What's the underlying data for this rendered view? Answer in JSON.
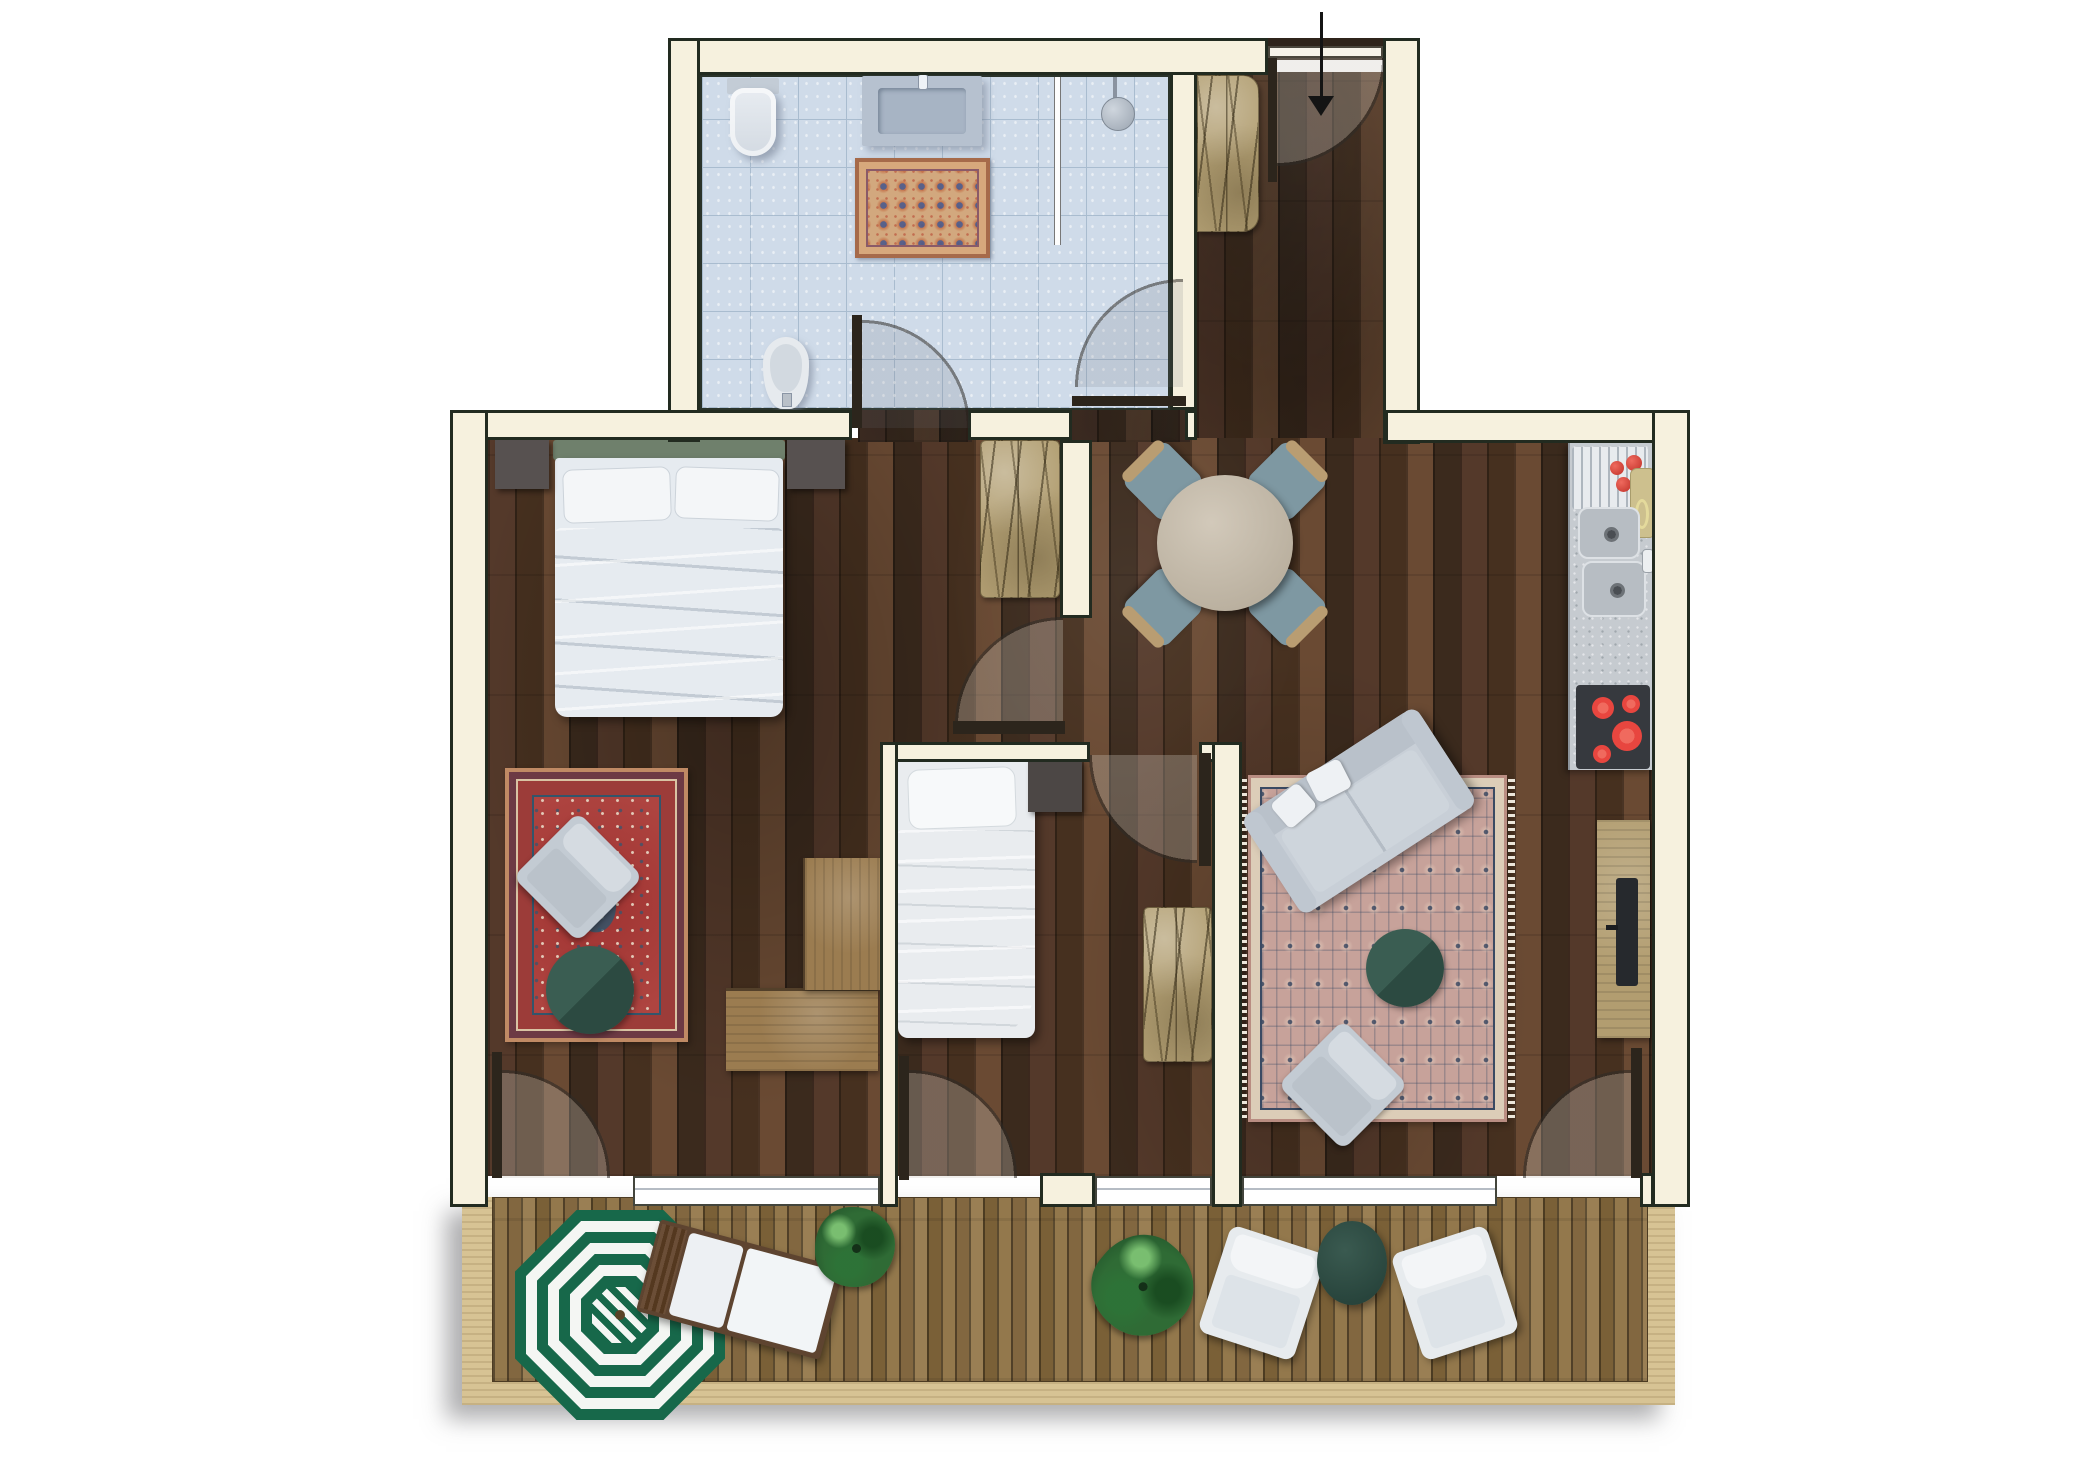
{
  "scene": {
    "type": "apartment-floor-plan",
    "view": "top-down",
    "visible_text": []
  },
  "colors": {
    "wall_fill": "#f6f1de",
    "wall_line": "#222b20",
    "wood_mid": "#54392a",
    "wood_dark": "#46301f",
    "wood_light": "#6a4a33",
    "tile": "#cfdbe9",
    "tile_line": "#a9bccf",
    "deck": "#8d744a",
    "deck_border": "#d7c394",
    "rug_red": "#ae4440",
    "rug_living": "#c7a29a",
    "navy": "#3a4a63",
    "green_furniture": "#2c4a41",
    "umbrella_green": "#17684a",
    "headboard_green": "#6f806c",
    "sofa_gray": "#c8cfd7",
    "cushion_white": "#eef1f4",
    "counter_gray": "#c6cbd0",
    "stove_dark": "#36393e",
    "burner_red": "#e8463f",
    "tan_hatch": "#b3a074",
    "bench_wood": "#9b7c50",
    "plant_green": "#2f6b35",
    "chair_teal": "#7e98a2",
    "chair_wood": "#b99d72",
    "window_glass": "#ffffff"
  },
  "rooms": [
    {
      "name": "bathroom",
      "floor": "light-blue-tile",
      "features": [
        "wall-hung-toilet",
        "vanity-sink",
        "shower-with-glass-screen",
        "shower-head",
        "bidet",
        "persian-bath-rug",
        "door-to-corridor",
        "door-to-entrance-hall"
      ]
    },
    {
      "name": "entrance-hall",
      "floor": "dark-wood",
      "features": [
        "entry-door-with-swing",
        "entry-direction-arrow",
        "hatched-wardrobe"
      ]
    },
    {
      "name": "master-bedroom",
      "floor": "dark-wood",
      "features": [
        "double-bed",
        "green-headboard",
        "two-pillows",
        "two-nightstands",
        "red-persian-rug",
        "lounge-chair",
        "round-green-side-table",
        "l-shaped-wood-bench",
        "terrace-door"
      ]
    },
    {
      "name": "small-bedroom",
      "floor": "dark-wood",
      "features": [
        "single-bed",
        "pillow",
        "nightstand",
        "hatched-wardrobe-bench",
        "entry-door",
        "terrace-door"
      ]
    },
    {
      "name": "corridor",
      "floor": "dark-wood",
      "features": [
        "hatched-storage-bench",
        "door-to-living-area"
      ]
    },
    {
      "name": "living-dining-kitchen",
      "floor": "dark-wood",
      "features": [
        "round-dining-table",
        "four-dining-chairs",
        "kitchen-counter",
        "drainboard",
        "tomatoes",
        "cutting-board",
        "double-sink",
        "four-burner-cooktop",
        "sofa",
        "two-sofa-pillows",
        "round-green-coffee-table",
        "lounge-chair",
        "persian-rug",
        "tv-sideboard",
        "tv",
        "terrace-door"
      ]
    },
    {
      "name": "terrace",
      "floor": "wood-decking",
      "features": [
        "green-white-striped-parasol",
        "sun-lounger",
        "two-potted-plants",
        "two-outdoor-armchairs",
        "round-green-outdoor-table",
        "light-wood-border"
      ]
    }
  ],
  "counts": {
    "stove_burners": 4,
    "dining_chairs": 4,
    "terrace_armchairs": 2,
    "plants": 2,
    "windows": 3,
    "door_swings": 8,
    "parasol_rings": 9
  }
}
